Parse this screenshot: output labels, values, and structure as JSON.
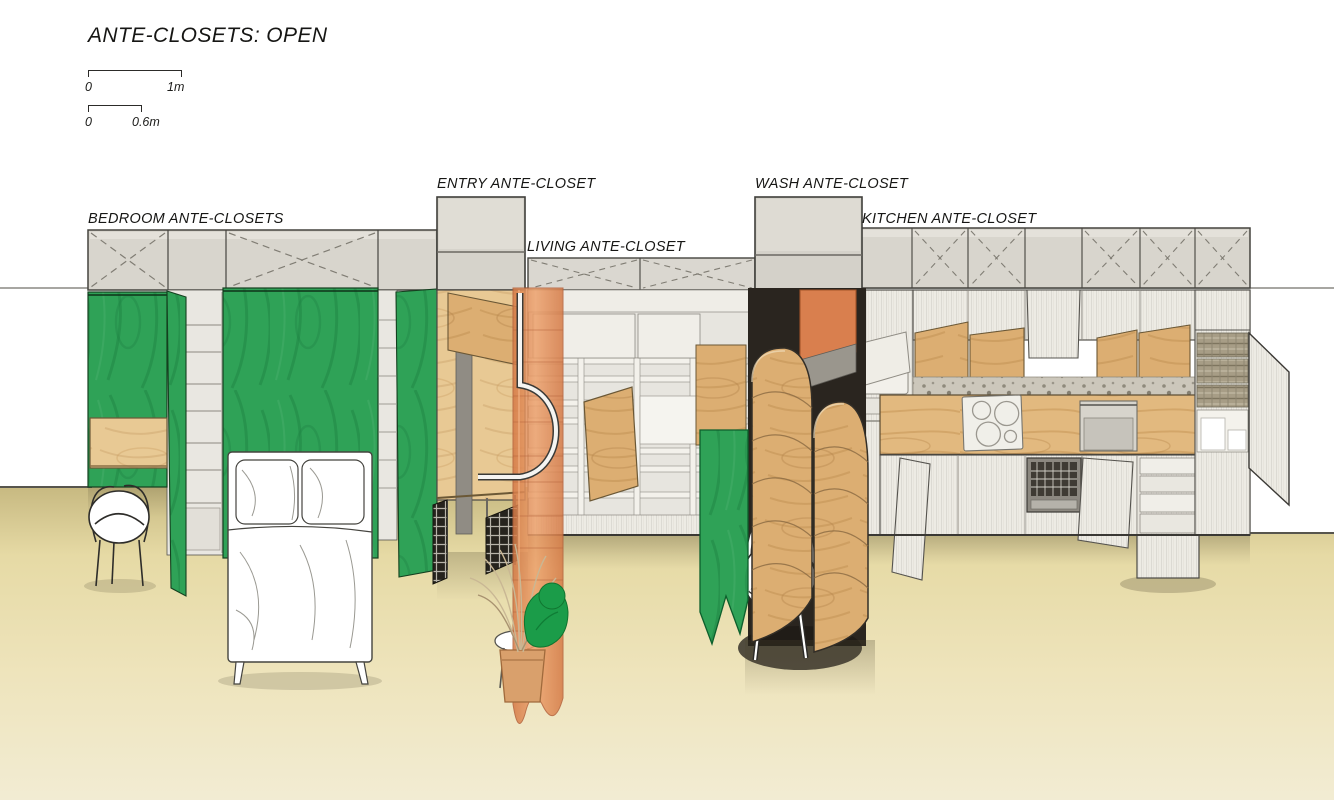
{
  "title": "ANTE-CLOSETS: OPEN",
  "scale_bars": [
    {
      "start": "0",
      "end": "1m"
    },
    {
      "start": "0",
      "end": "0.6m"
    }
  ],
  "sections": {
    "bedroom": {
      "label": "BEDROOM ANTE-CLOSETS"
    },
    "entry": {
      "label": "ENTRY ANTE-CLOSET"
    },
    "living": {
      "label": "LIVING ANTE-CLOSET"
    },
    "wash": {
      "label": "WASH ANTE-CLOSET"
    },
    "kitchen": {
      "label": "KITCHEN ANTE-CLOSET"
    }
  },
  "colors": {
    "floor": "#e7dba6",
    "floor_light": "#f2ecd3",
    "floor_shadow": "#4a432c",
    "cabinet_gray": "#d8d5cd",
    "door_white": "#edebe4",
    "green_plywood": "#2fa257",
    "green_dark": "#1d8041",
    "green_banner": "#16a04d",
    "plywood_light": "#e8c994",
    "plywood_mid": "#dcae72",
    "plywood_counter": "#e2b97f",
    "orange_curtain": "#e4935f",
    "orange_panel": "#d97f4e",
    "terrazzo": "#ccc7bb",
    "dark_interior": "#2a251f",
    "line": "#403f3a"
  }
}
